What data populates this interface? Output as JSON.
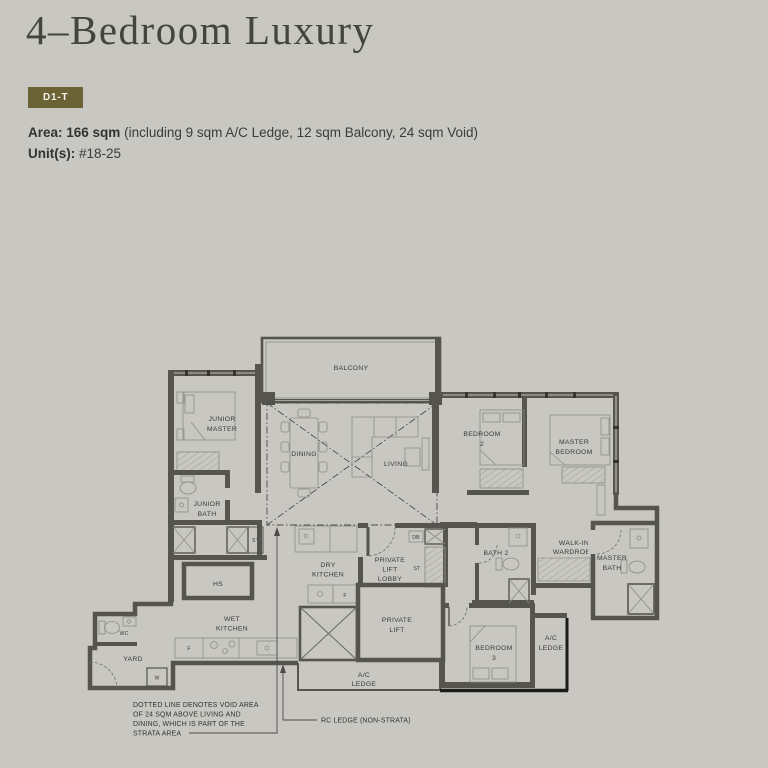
{
  "header": {
    "title": "4–Bedroom Luxury",
    "type_badge": "D1-T",
    "area_label": "Area: 166 sqm",
    "area_note": "(including 9 sqm A/C Ledge, 12 sqm Balcony, 24 sqm Void)",
    "units_label": "Unit(s):",
    "units_value": "#18-25"
  },
  "colors": {
    "background": "#c8c7c1",
    "badge": "#6b6335",
    "wall": "#55544e",
    "furniture_line": "#8e8d87",
    "label_text": "#3b3a36",
    "rc_ledge_line": "#1b1b19"
  },
  "floor_plan": {
    "labels": {
      "balcony": [
        "BALCONY"
      ],
      "junior_master": [
        "JUNIOR",
        "MASTER"
      ],
      "dining": [
        "DINING"
      ],
      "living": [
        "LIVING"
      ],
      "bedroom2": [
        "BEDROOM",
        "2"
      ],
      "master_bedroom": [
        "MASTER",
        "BEDROOM"
      ],
      "junior_bath": [
        "JUNIOR",
        "BATH"
      ],
      "st_store": [
        "ST"
      ],
      "hs": [
        "HS"
      ],
      "wc": [
        "WC"
      ],
      "yard": [
        "YARD"
      ],
      "washer": [
        "W"
      ],
      "fridge_wet": [
        "F"
      ],
      "wet_kitchen": [
        "WET",
        "KITCHEN"
      ],
      "dry_kitchen": [
        "DRY",
        "KITCHEN"
      ],
      "fridge_dry": [
        "F"
      ],
      "private_lift_lobby": [
        "PRIVATE",
        "LIFT",
        "LOBBY"
      ],
      "db": [
        "DB"
      ],
      "st_lobby": [
        "ST"
      ],
      "private_lift": [
        "PRIVATE",
        "LIFT"
      ],
      "bath2": [
        "BATH 2"
      ],
      "walk_in_wardrobe": [
        "WALK-IN",
        "WARDROBE"
      ],
      "master_bath": [
        "MASTER",
        "BATH"
      ],
      "bedroom3": [
        "BEDROOM",
        "3"
      ],
      "ac_ledge_bottom": [
        "A/C",
        "LEDGE"
      ],
      "ac_ledge_right": [
        "A/C",
        "LEDGE"
      ]
    },
    "annotations": {
      "void_note": [
        "DOTTED LINE DENOTES VOID AREA",
        "OF 24 SQM ABOVE LIVING AND",
        "DINING, WHICH IS PART OF THE",
        "STRATA AREA"
      ],
      "rc_ledge_note": "RC LEDGE (NON-STRATA)"
    }
  }
}
